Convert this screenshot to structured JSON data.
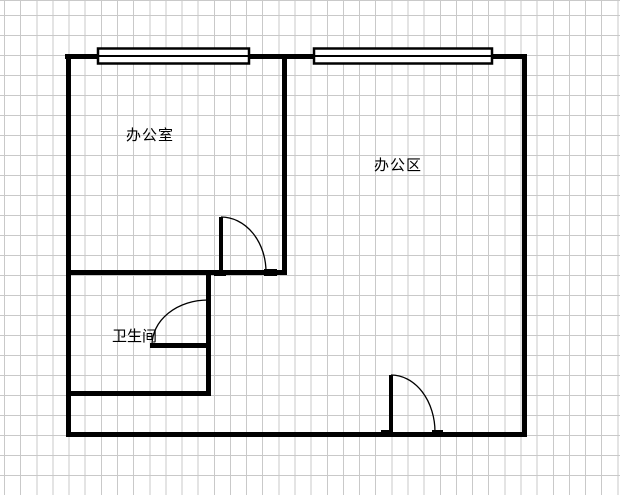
{
  "canvas": {
    "background_color": "#ffffff",
    "grid_line_color": "#c9c9c9",
    "grid_cell_width_px": 16.14,
    "grid_cell_height_px": 20
  },
  "floor_plan": {
    "wall_color": "#000000",
    "labels": {
      "office": "办公室",
      "office_area": "办公区",
      "bathroom": "卫生间"
    },
    "window_count": 2,
    "door_count": 3
  }
}
